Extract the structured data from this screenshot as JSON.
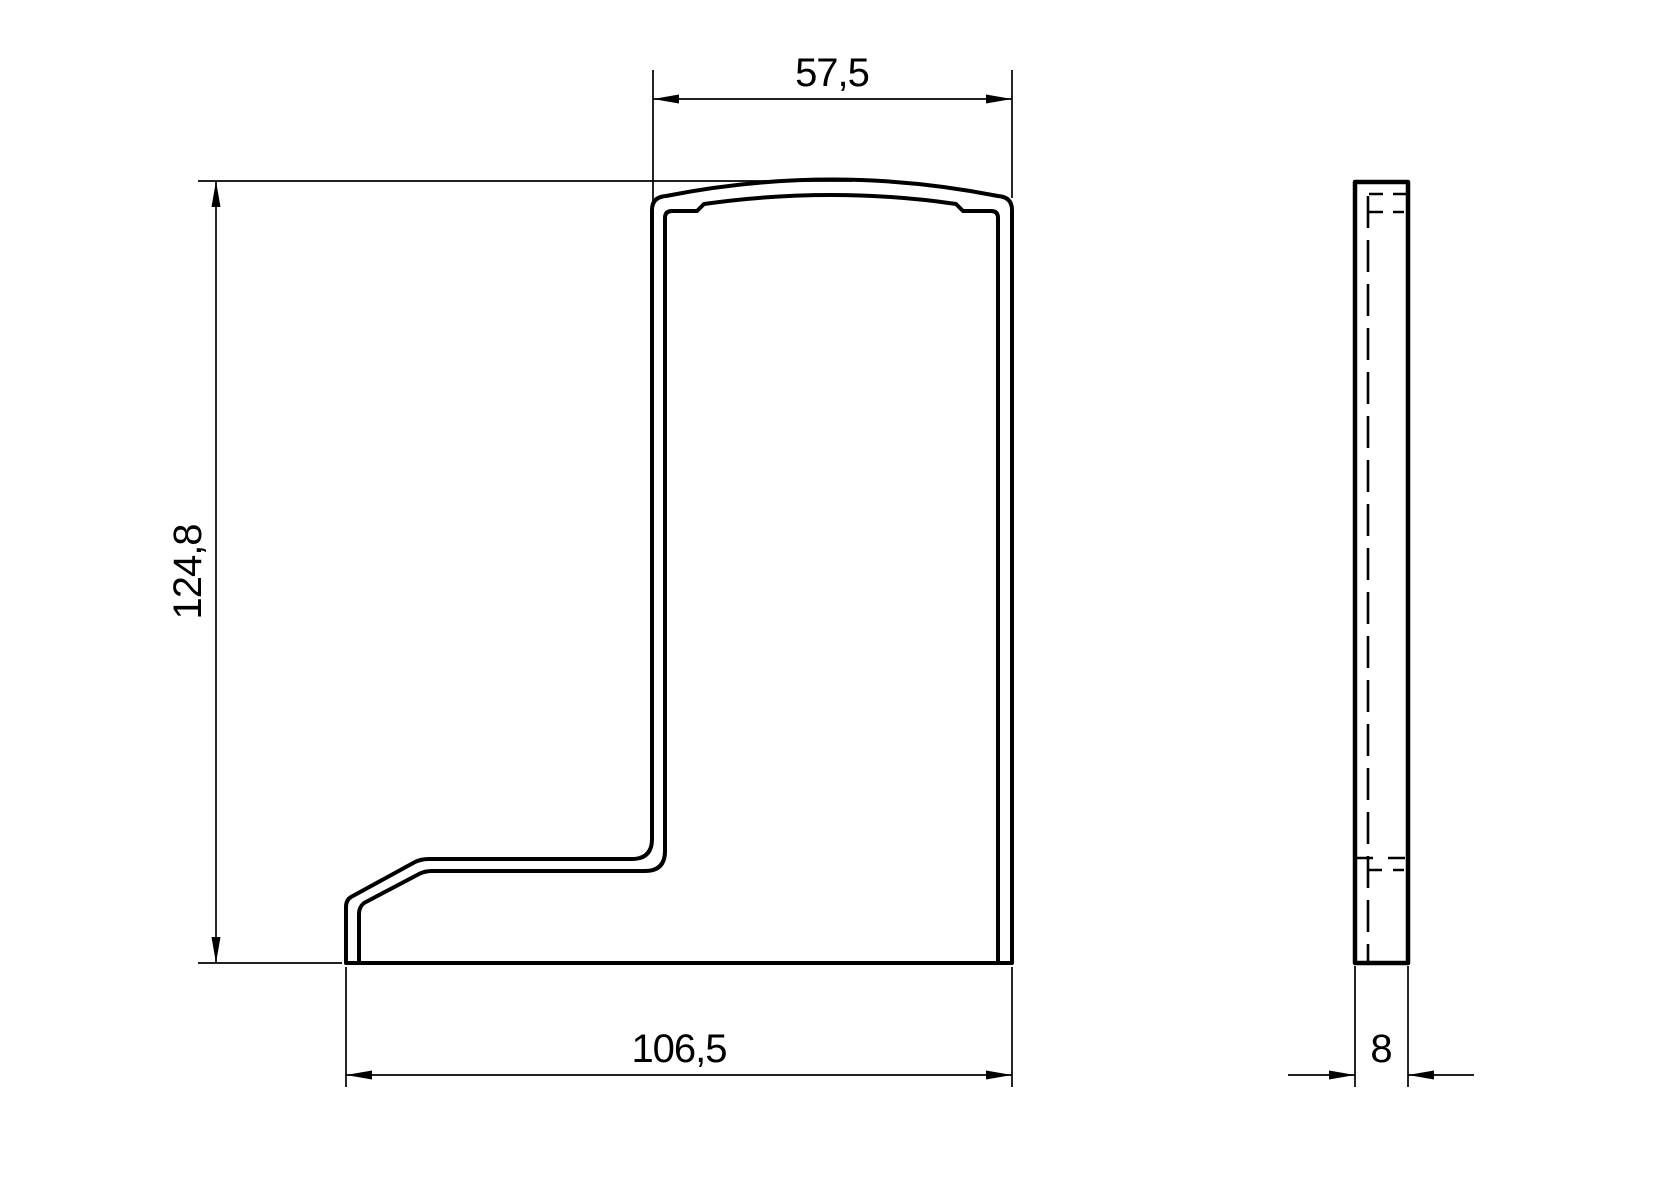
{
  "drawing": {
    "kind": "technical-dimension-drawing",
    "background_color": "#ffffff",
    "line_color": "#000000",
    "views": {
      "front_view": "L-shaped profile cross-section with arched top and stepped foot",
      "side_view": "thin vertical plate with hidden dashed edges"
    },
    "dimensions": {
      "top_width": "57,5",
      "height": "124,8",
      "bottom_width": "106,5",
      "thickness": "8"
    }
  }
}
